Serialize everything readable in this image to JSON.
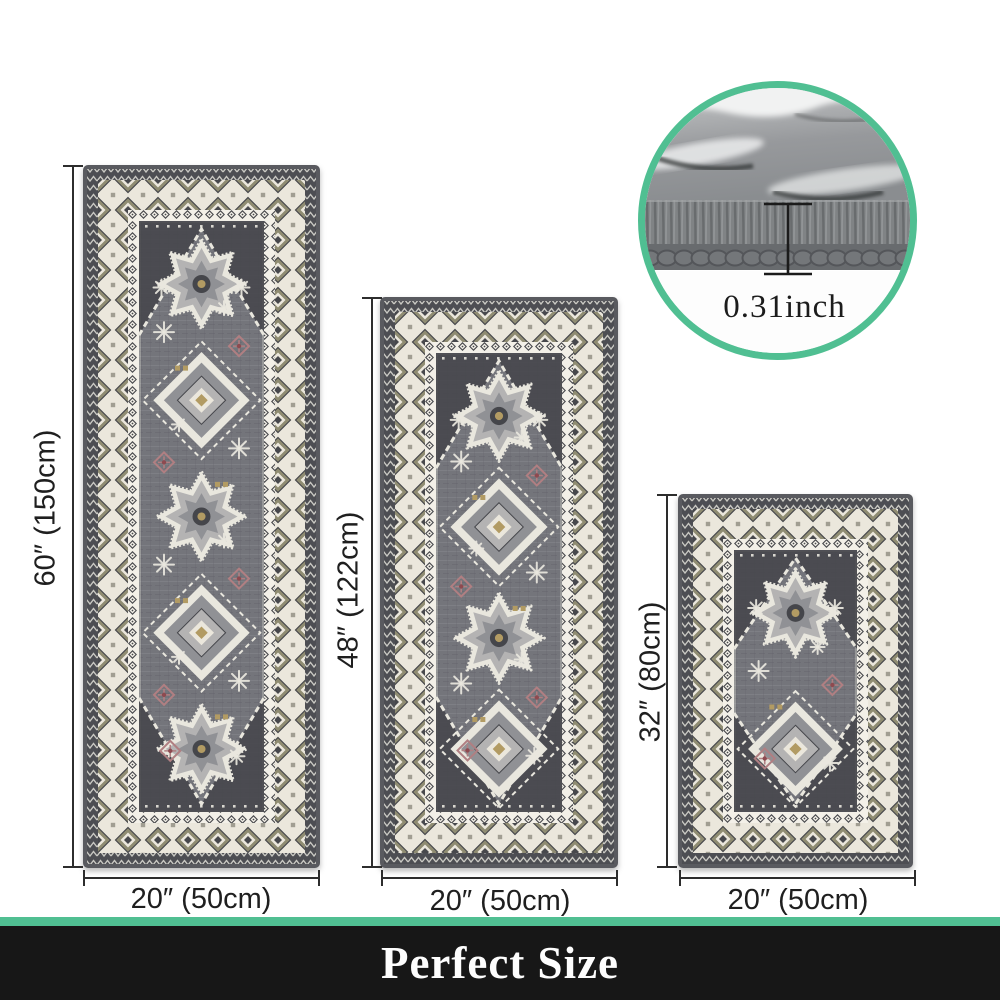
{
  "accent_color": "#50bf92",
  "banner": {
    "label": "Perfect Size",
    "bg_color": "#171717",
    "text_color": "#fdfdfd"
  },
  "inset": {
    "thickness_label": "0.31inch"
  },
  "rugs": [
    {
      "height_label": "60″ (150cm)",
      "width_label": "20″ (50cm)"
    },
    {
      "height_label": "48″ (122cm)",
      "width_label": "20″ (50cm)"
    },
    {
      "height_label": "32″ (80cm)",
      "width_label": "20″ (50cm)"
    }
  ],
  "rug_palette": {
    "edge": "#595a5f",
    "band_dark": "#4d4e53",
    "cream": "#ebe7dc",
    "chain_bg": "#f3f0e8",
    "motif_dark": "#47484c",
    "motif_olive": "#8f8c72",
    "motif_gray": "#a19e92",
    "field": "#74757b",
    "field_light": "#8e8f95",
    "field_dark": "#606167",
    "corner": "#45464b",
    "white": "#e9e7de",
    "med_light": "#b4b3b3",
    "med_mid": "#909195",
    "gold": "#b29b63",
    "pink": "#b07f82",
    "pink_dark": "#8d4a50"
  }
}
